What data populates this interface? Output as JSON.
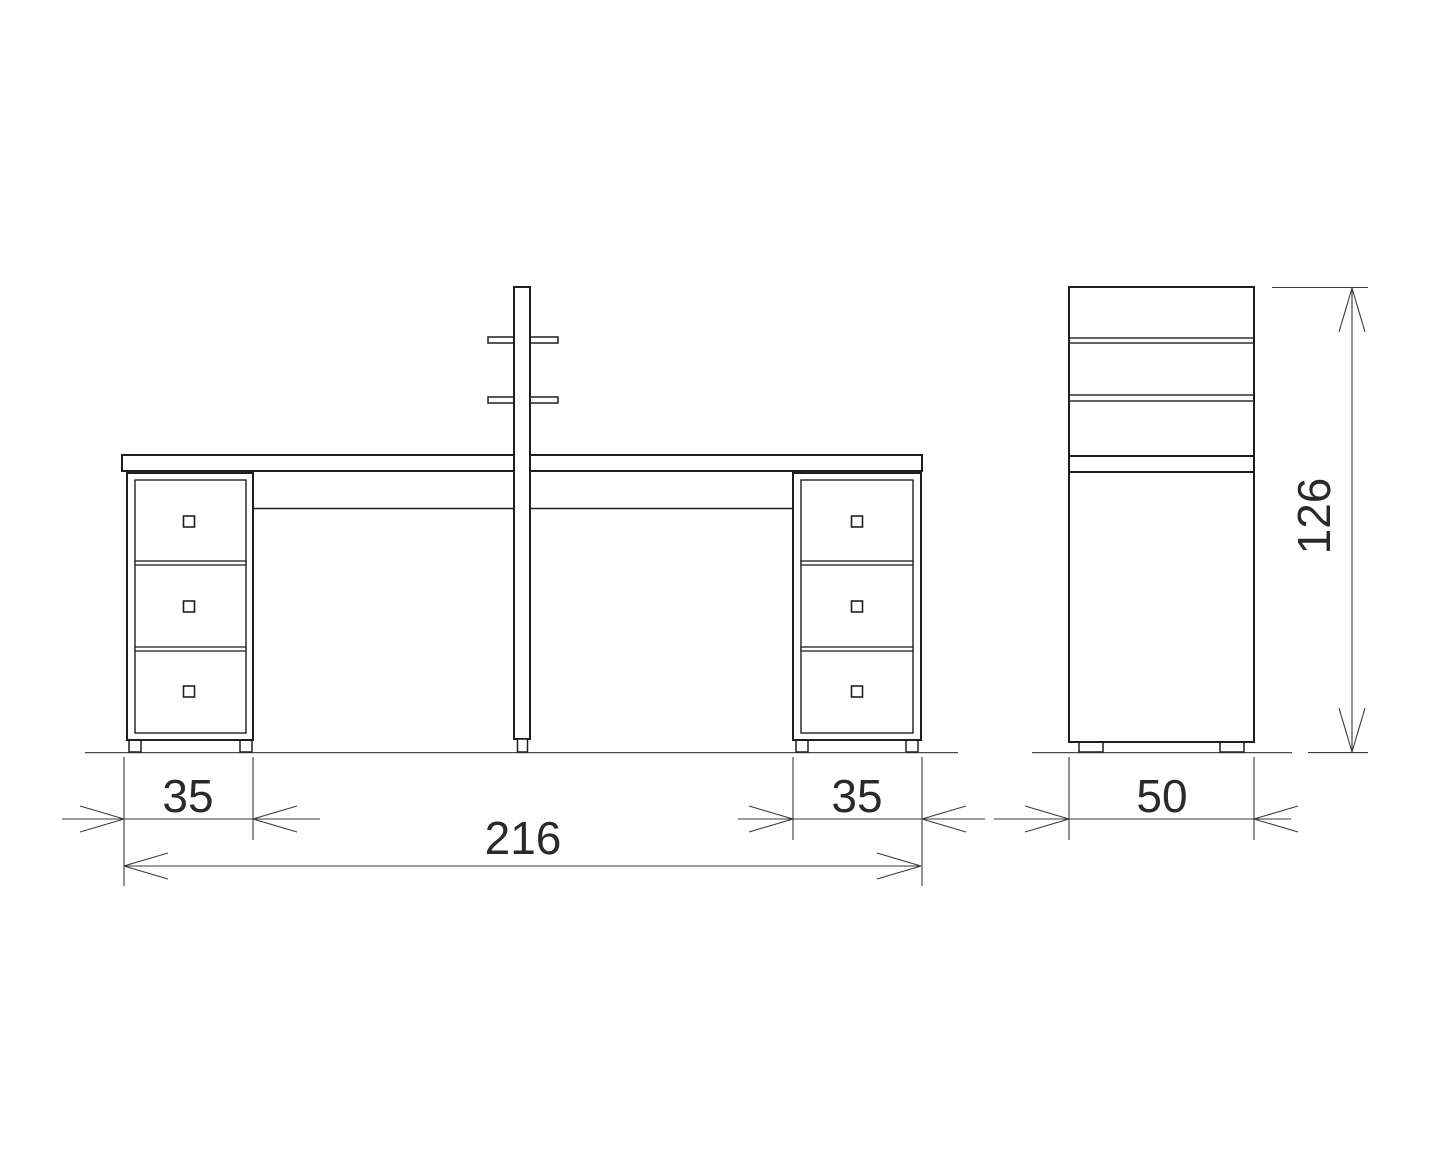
{
  "drawing": {
    "kind": "furniture-technical-drawing",
    "background": "#ffffff",
    "line_color": "#1f1f1f",
    "dimension_line_color": "#3a3a3a",
    "ground_line_color": "#4a4a4a",
    "front_view": {
      "left_pedestal_drawers": 3,
      "right_pedestal_drawers": 3,
      "pole_shelves": 2
    },
    "side_view": {
      "shelf_bands": 2
    }
  },
  "dimensions": {
    "left_pedestal_width": "35",
    "right_pedestal_width": "35",
    "overall_width": "216",
    "side_depth": "50",
    "overall_height": "126"
  }
}
